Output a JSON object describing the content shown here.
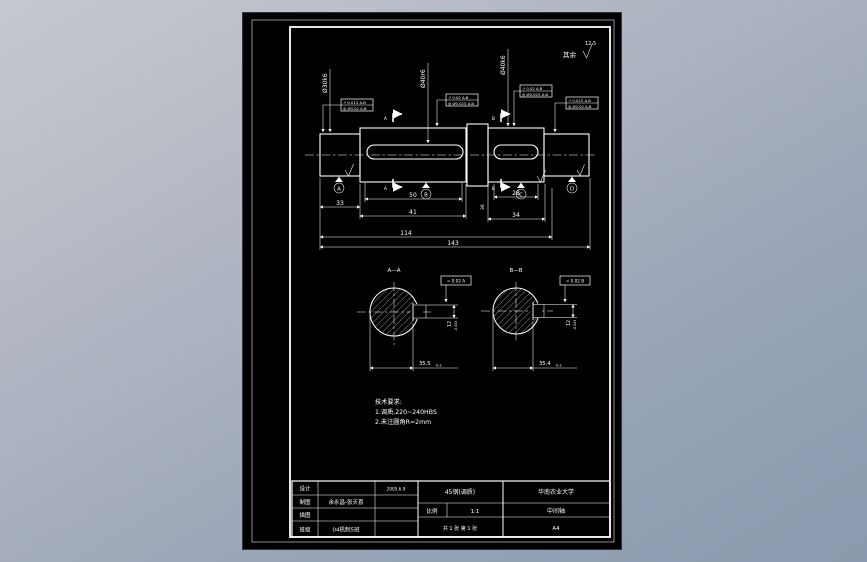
{
  "drawing": {
    "corner_note": {
      "prefix": "其余",
      "value": "12.5"
    },
    "main_view": {
      "dia_labels": [
        "Ø30k6",
        "Ø40r6",
        "Ø40k6"
      ],
      "frames": [
        {
          "row1": "↗ 0.015 A-B",
          "row2": "◎ Ø0.02 A-B"
        },
        {
          "row1": "↗ 0.02 A-B",
          "row2": "◎ Ø0.025 A-B"
        },
        {
          "row1": "↗ 0.02 A-B",
          "row2": "◎ Ø0.025 A-B"
        },
        {
          "row1": "↗ 0.015 A-B",
          "row2": "◎ Ø0.02 A-B"
        }
      ],
      "datums": [
        "A",
        "B",
        "C",
        "D"
      ],
      "cut_labels": {
        "left": "A",
        "right": "B"
      },
      "dims": {
        "d1": "33",
        "d2": "50",
        "d3": "41",
        "d4": "28",
        "d5": "34",
        "d6": "36",
        "d7": "114",
        "d8": "143"
      }
    },
    "section_a": {
      "label": "A—A",
      "fcf": "= 0.02 A",
      "width": "12",
      "width_tol": "-0.043",
      "depth": "35.5",
      "depth_tol": "-0.2"
    },
    "section_b": {
      "label": "B—B",
      "fcf": "= 0.02 B",
      "width": "12",
      "width_tol": "-0.043",
      "depth": "35.4",
      "depth_tol": "-0.2"
    },
    "tech": {
      "title": "技术要求:",
      "items": [
        "1.调质,220~240HBS",
        "2.未注圆角R=2mm"
      ]
    },
    "title_block": {
      "rows": [
        {
          "label": "设计",
          "value": ""
        },
        {
          "label": "制图",
          "value": "余永昌-张天喜"
        },
        {
          "label": "描图",
          "value": ""
        },
        {
          "label": "班级",
          "value": "04机制5班"
        }
      ],
      "date": "2005.6.9",
      "material": "45钢(调质)",
      "scale_label": "比例",
      "scale_value": "1:1",
      "sheet_info": "共 1 张  第 1 张",
      "university": "华南农业大学",
      "part_name": "中间轴",
      "paper_size": "A4"
    }
  }
}
